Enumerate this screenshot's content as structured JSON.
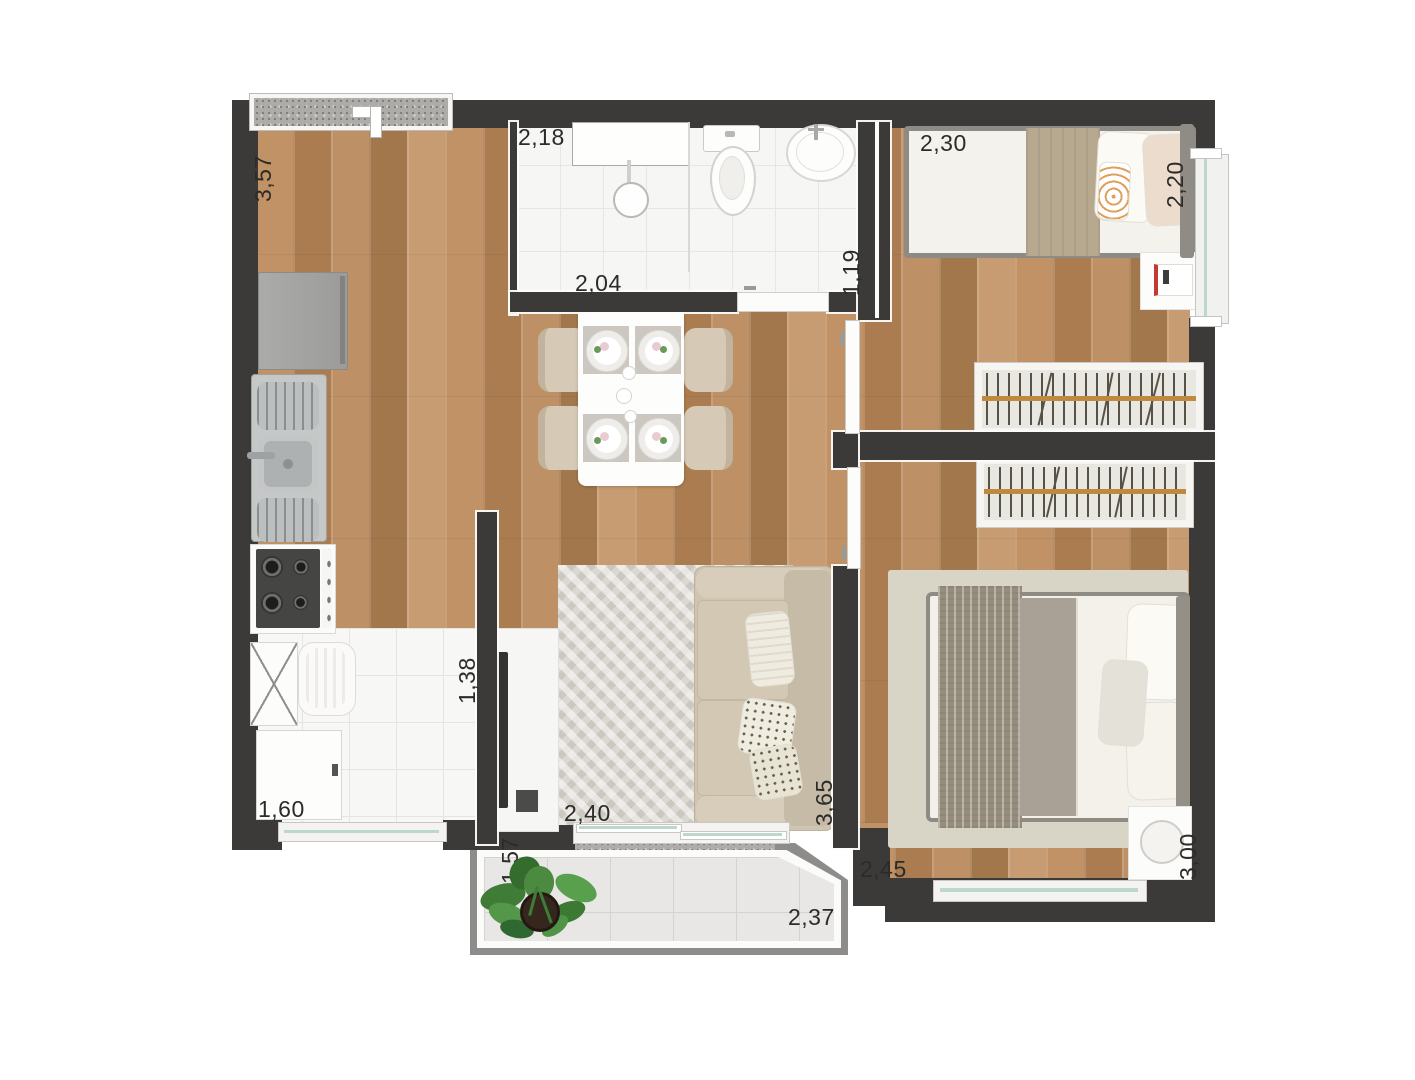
{
  "floor_plan": {
    "type": "apartment-2-bedroom-top-view",
    "dimensions_m": {
      "kitchen_side": "3,57",
      "bathroom_width": "2,18",
      "bathroom_inner_width": "2,04",
      "bathroom_depth": "1,19",
      "bedroom1_width": "2,30",
      "bedroom1_depth": "2,20",
      "service_depth": "1,38",
      "service_width": "1,60",
      "living_width": "2,40",
      "living_depth": "3,65",
      "bedroom2_width": "2,45",
      "bedroom2_depth": "3,00",
      "balcony_width": "2,37",
      "balcony_depth": "1,57"
    },
    "colors": {
      "wall": "#3b3a38",
      "wood_floor": "#b5895c",
      "bathroom_tile": "#f6f6f5",
      "balcony_frame": "#8d8c8a",
      "balcony_tile": "#e8e7e5",
      "dimension_text": "#2c2b29",
      "wardrobe_rod": "#bf8a3d",
      "sofa_fabric": "#cfc4b0",
      "plant_green": "#4c8a40",
      "glass": "#bcd8ca"
    }
  }
}
